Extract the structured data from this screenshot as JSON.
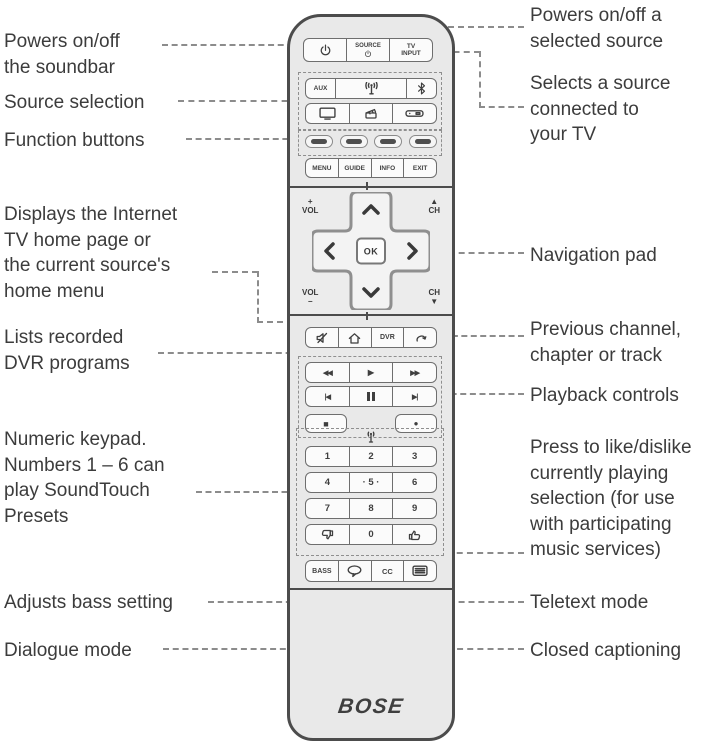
{
  "labels": {
    "left": [
      "Powers on/off\nthe soundbar",
      "Source selection",
      "Function buttons",
      "Displays the Internet\nTV home page or\nthe current source's\nhome menu",
      "Lists recorded\nDVR programs",
      "Numeric keypad.\nNumbers 1 – 6 can\nplay SoundTouch\nPresets",
      "Adjusts bass setting",
      "Dialogue mode"
    ],
    "right": [
      "Powers on/off a\nselected source",
      "Selects a source\nconnected to\nyour TV",
      "Navigation pad",
      "Previous channel,\nchapter or track",
      "Playback controls",
      "Press to like/dislike\ncurrently playing\nselection (for use\nwith participating\nmusic services)",
      "Teletext mode",
      "Closed captioning"
    ]
  },
  "remote": {
    "brand": "BOSE",
    "power_row": {
      "source_label": "SOURCE",
      "tv_input_label": "TV\nINPUT"
    },
    "source_buttons": {
      "aux_label": "AUX"
    },
    "menu_row": [
      "MENU",
      "GUIDE",
      "INFO",
      "EXIT"
    ],
    "nav": {
      "ok_label": "OK",
      "vol_up": "+\nVOL",
      "ch_up": "▲\nCH",
      "vol_down": "VOL\n−",
      "ch_down": "CH\n▼"
    },
    "dvr_label": "DVR",
    "glyphs": {
      "rewind": "◀◀",
      "play": "▶",
      "fast_forward": "▶▶",
      "skip_back": "|◀",
      "skip_forward": "▶|",
      "stop": "■",
      "record": "●"
    },
    "keypad": {
      "row1": [
        "1",
        "2",
        "3"
      ],
      "row2": [
        "4",
        "· 5 ·",
        "6"
      ],
      "row3": [
        "7",
        "8",
        "9"
      ],
      "zero": "0"
    },
    "bottom_row": {
      "bass_label": "BASS",
      "cc_label": "CC"
    }
  },
  "icons": {
    "power": "power-icon",
    "soundtouch": "antenna-icon",
    "bluetooth": "bluetooth-icon",
    "tv": "tv-icon",
    "media_player": "media-player-icon",
    "set_top_box": "set-top-box-icon",
    "mute": "mute-icon",
    "home": "home-icon",
    "return": "return-arrow-icon",
    "pause": "pause-icon",
    "thumbs_down": "thumbs-down-icon",
    "thumbs_up": "thumbs-up-icon",
    "dialogue": "speech-bubble-icon",
    "teletext": "teletext-icon"
  },
  "colors": {
    "remote_body": "#e9e9e9",
    "outline": "#4c4c4c",
    "dash": "#8c8c8c",
    "text": "#3c3c3c"
  }
}
